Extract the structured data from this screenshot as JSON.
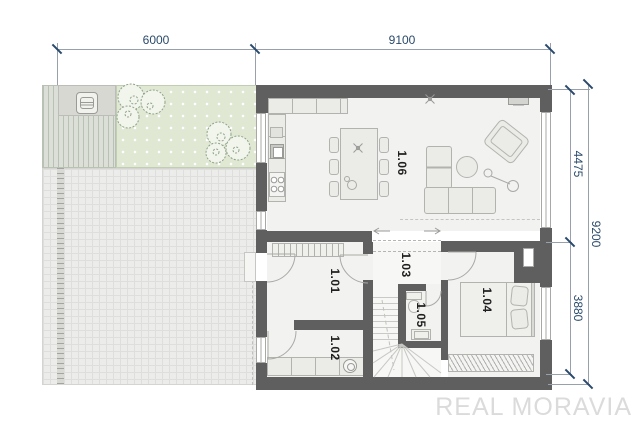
{
  "plan": {
    "rooms": [
      {
        "id": "1.01"
      },
      {
        "id": "1.02"
      },
      {
        "id": "1.03"
      },
      {
        "id": "1.04"
      },
      {
        "id": "1.05"
      },
      {
        "id": "1.06"
      }
    ],
    "dimensions": {
      "top": [
        {
          "label": "6000"
        },
        {
          "label": "9100"
        }
      ],
      "right": [
        {
          "label": "4475"
        },
        {
          "label": "9200"
        },
        {
          "label": "3880"
        }
      ]
    },
    "watermark": "REAL MORAVIA"
  },
  "colors": {
    "wall": "#5f5f5f",
    "floor": "#f2f2f0",
    "hall_floor": "#f7f7f5",
    "garden": "#e0e8d4",
    "deck": "#dcdfd8",
    "deck_line": "#b9c0b4",
    "patio": "#d8d8d3",
    "paved": "#ececea",
    "paved_grid": "#dededc",
    "furniture": "#ebebe8",
    "furniture_line": "#b2b2af",
    "dim_text": "#2a4a6b",
    "dim_line": "#98a0ac",
    "room_label": "#1f1f1f",
    "watermark": "#dbdbdb",
    "tree": "#8fa289"
  }
}
